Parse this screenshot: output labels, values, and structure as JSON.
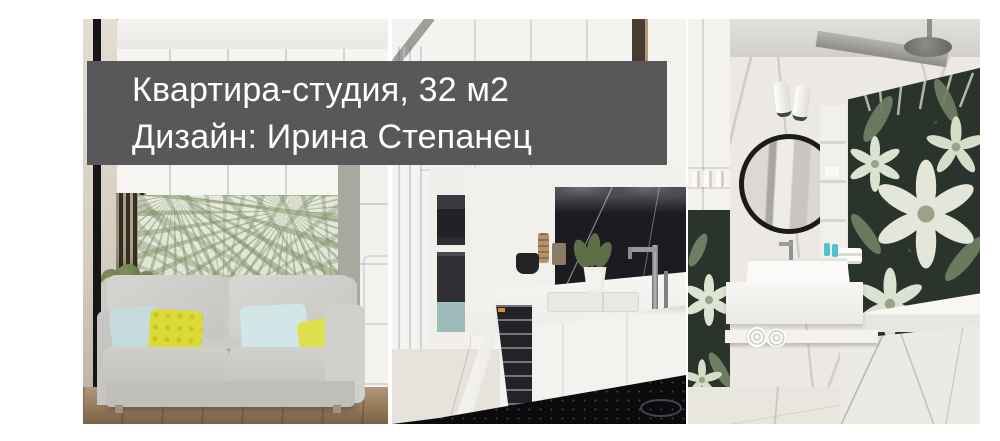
{
  "banner": {
    "title": "Квартира-студия, 32 м2",
    "subtitle": "Дизайн: Ирина Степанец",
    "background_color": "#58585a",
    "text_color": "#ffffff"
  },
  "photos": [
    {
      "name": "living-room-render",
      "alt": "gray sofa, yellow and blue pillows, palm-leaf wallpaper, white cabinets"
    },
    {
      "name": "kitchen-render",
      "alt": "white kitchen, blue curtain, dark marble backsplash, open dishwasher, black cooktop"
    },
    {
      "name": "bathroom-render",
      "alt": "round black-frame mirror, white floating vanity, rolled towels, floral mosaic wall, bathtub, rain shower"
    }
  ],
  "palette": {
    "page_background": "#ffffff",
    "sofa_gray": "#cbcac7",
    "pillow_yellow": "#dbda36",
    "pillow_blue": "#c5dbde",
    "palm_leaf_green": "#8a9a76",
    "curtain_teal": "#9fbfc6",
    "backsplash_black": "#1c1b20",
    "mosaic_dark_green": "#2a332c",
    "wood_floor": "#96795a",
    "marble_light": "#ece9e4"
  }
}
